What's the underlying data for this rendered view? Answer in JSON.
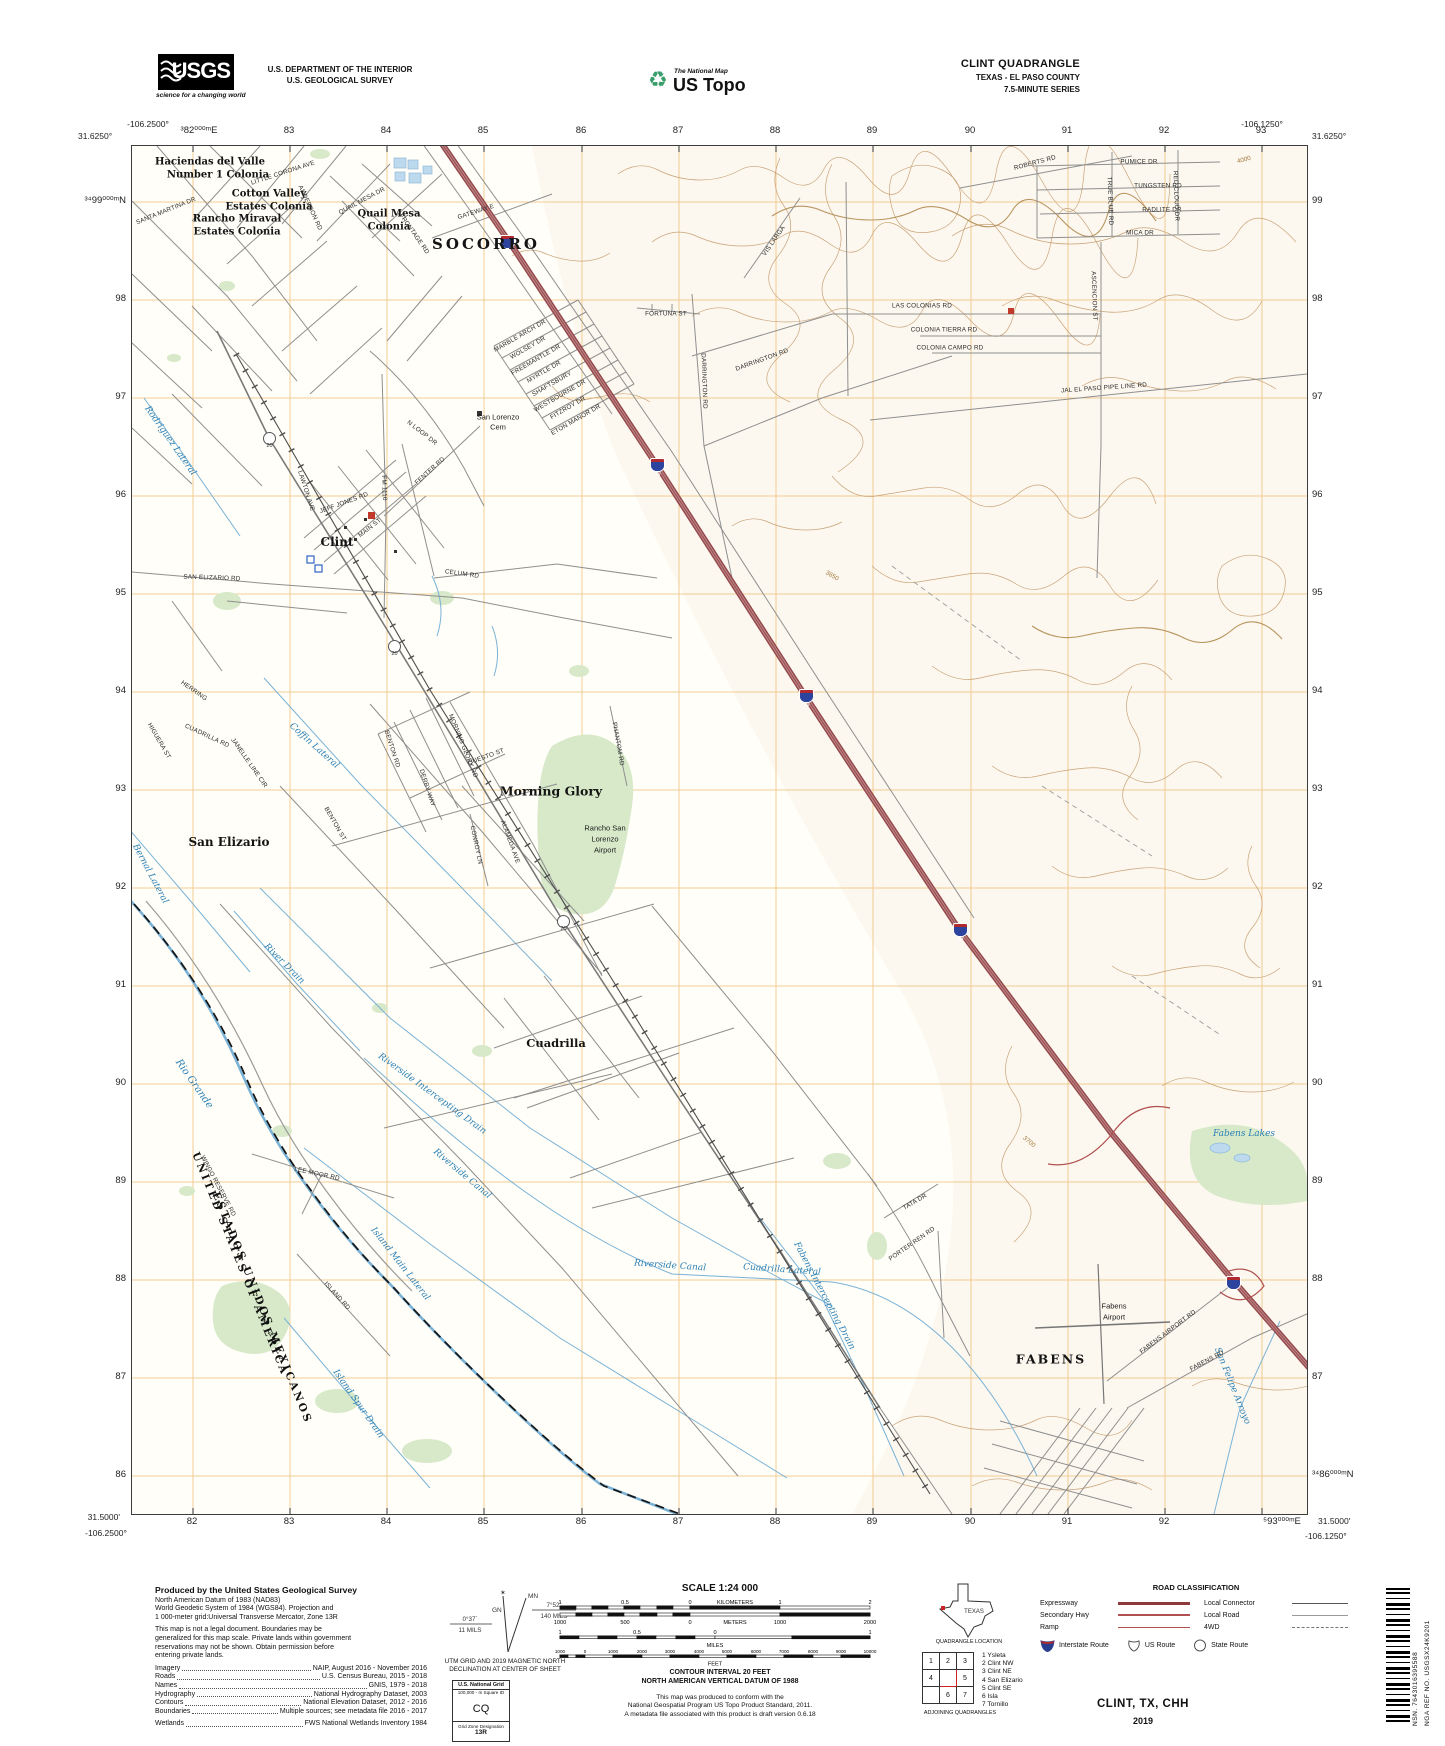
{
  "header": {
    "usgs": "USGS",
    "usgs_tagline": "science for a changing world",
    "dept_line1": "U.S. DEPARTMENT OF THE INTERIOR",
    "dept_line2": "U.S. GEOLOGICAL SURVEY",
    "ustopo_small": "The National Map",
    "ustopo_big": "US Topo",
    "quad_title": "CLINT QUADRANGLE",
    "quad_sub1": "TEXAS - EL PASO COUNTY",
    "quad_sub2": "7.5-MINUTE SERIES"
  },
  "edges": {
    "tl_lon": "-106.2500°",
    "tl_lat": "31.6250°",
    "tr_lon": "-106.1250°",
    "tr_lat": "31.6250°",
    "bl_lat": "31.5000'",
    "bl_lon": "-106.2500°",
    "br_lat": "31.5000'",
    "br_lon": "-106.1250°",
    "top": [
      "³82⁰⁰⁰ᵐE",
      "83",
      "84",
      "85",
      "86",
      "87",
      "88",
      "89",
      "90",
      "91",
      "92",
      "93"
    ],
    "bottom": [
      "82",
      "83",
      "84",
      "85",
      "86",
      "87",
      "88",
      "89",
      "90",
      "91",
      "92",
      "⁵93⁰⁰⁰ᵐE"
    ],
    "left": [
      "³⁴99⁰⁰⁰ᵐN",
      "98",
      "97",
      "96",
      "95",
      "94",
      "93",
      "92",
      "91",
      "90",
      "89",
      "88",
      "87",
      "86"
    ],
    "right": [
      "99",
      "98",
      "97",
      "96",
      "95",
      "94",
      "93",
      "92",
      "91",
      "90",
      "89",
      "88",
      "87",
      "³⁴86⁰⁰⁰ᵐN"
    ]
  },
  "map": {
    "i10": "10",
    "r20": "20",
    "towns": {
      "socorro": "SOCORRO",
      "clint": "Clint",
      "san_elizario": "San Elizario",
      "morning_glory": "Morning Glory",
      "cuadrilla": "Cuadrilla",
      "fabens": "FABENS"
    },
    "colonias": {
      "hdv1": "Haciendas del Valle",
      "hdv2": "Number 1 Colonia",
      "cv1": "Cotton Valley",
      "cv2": "Estates Colonia",
      "rm1": "Rancho Miraval",
      "rm2": "Estates Colonia",
      "qm1": "Quail Mesa",
      "qm2": "Colonia"
    },
    "sites": {
      "rsl1": "Rancho San",
      "rsl2": "Lorenzo",
      "rsl3": "Airport",
      "fa1": "Fabens",
      "fa2": "Airport",
      "cem1": "San Lorenzo",
      "cem2": "Cem"
    },
    "boundary": {
      "us": "UNITED STATES OF AMERICA",
      "mx": "ESTADOS UNIDOS MEXICANOS"
    },
    "water": [
      "Rio Grande",
      "Riverside Intercepting Drain",
      "Riverside Canal",
      "Island Main Lateral",
      "Island Spur Drain",
      "Bernal Lateral",
      "Coffin Lateral",
      "Rodriguez Lateral",
      "Riverside Canal",
      "Cuadrilla Lateral",
      "Fabens Intercepting Drain",
      "Fabens Lakes",
      "River Drain",
      "San Felipe Arroyo"
    ],
    "roads": [
      "SAN ELIZARIO RD",
      "JEFF JONES RD",
      "MAIN ST",
      "LAWTON AVE",
      "FM 1110",
      "N LOOP DR",
      "FENTER RD",
      "CELUM RD",
      "FRONTAGE RD",
      "GATEWAY E",
      "MARBLE ARCH DR",
      "WOLSEY DR",
      "FREEMANTLE DR",
      "MYRTLE DR",
      "SHAFTSBURY",
      "WESTBOURNE DR",
      "FITZROY DR",
      "ETON MANOR DR",
      "FORTUNA ST",
      "DARRINGTON RD",
      "DARRINGTON RD",
      "VIS LARGA",
      "JAL EL PASO PIPE LINE RD",
      "ROBERTS RD",
      "PUMICE DR",
      "TUNGSTEN RD",
      "RADLITE DR",
      "MICA DR",
      "TRUE BLUE RD",
      "RED CLOUD DR",
      "ASCENCION ST",
      "LAS COLONIAS RD",
      "COLONIA TIERRA RD",
      "COLONIA CAMPO RD",
      "CUADRILLA RD",
      "HERRING",
      "JANELLE LINE CIR",
      "BENTON RD",
      "BENTON ST",
      "DERBY WAY",
      "MORNING GLORY RD",
      "QUESTO ST",
      "CONROY LN",
      "ALAMEDA AVE",
      "PHANTOM RD",
      "HIGUERA ST",
      "LEE MOOR RD",
      "ISLAND RD",
      "WINGO RESERVE RD",
      "TATA DR",
      "PORTER REN RD",
      "FABENS AIRPORT RD",
      "FABENS RD",
      "SANTA MARTINA DR",
      "ANDERSON RD",
      "QUAIL MESA DR",
      "LITTLE CORONA AVE"
    ],
    "contour_labels": [
      "3700",
      "3650",
      "4000"
    ]
  },
  "footer": {
    "produced_by": "Produced by the United States Geological Survey",
    "datum_lines": [
      "North American Datum of 1983 (NAD83)",
      "World Geodetic System of 1984 (WGS84).  Projection and",
      "1 000-meter grid:Universal Transverse Mercator, Zone 13R"
    ],
    "legal_lines": [
      "This map is not a legal document. Boundaries may be",
      "generalized for this map scale. Private lands within government",
      "reservations may not be shown. Obtain permission before",
      "entering private lands."
    ],
    "credits": [
      {
        "label": "Imagery",
        "value": "NAIP, August 2016 - November 2016"
      },
      {
        "label": "Roads",
        "value": "U.S. Census Bureau, 2015 - 2018"
      },
      {
        "label": "Names",
        "value": "GNIS, 1979 - 2018"
      },
      {
        "label": "Hydrography",
        "value": "National Hydrography Dataset, 2003"
      },
      {
        "label": "Contours",
        "value": "National Elevation Dataset, 2012 - 2016"
      },
      {
        "label": "Boundaries",
        "value": "Multiple sources; see metadata file 2016 - 2017"
      },
      {
        "label": "Wetlands",
        "value": "FWS National Wetlands Inventory 1984"
      }
    ],
    "declination": {
      "mn": "MN",
      "gn": "GN",
      "left_deg": "0°37´",
      "left_mils": "11 MILS",
      "right_deg": "7°52´",
      "right_mils": "140 MILS",
      "note1": "UTM GRID AND 2019 MAGNETIC NORTH",
      "note2": "DECLINATION AT CENTER OF SHEET"
    },
    "usng": {
      "title": "U.S. National Grid",
      "sub": "100,000 - m Square ID",
      "square": "CQ",
      "zone_label": "Grid Zone Designation",
      "zone": "13R"
    },
    "scale": {
      "title": "SCALE 1:24 000",
      "km_label": "KILOMETERS",
      "m_label": "METERS",
      "mi_label": "MILES",
      "ft_label": "FEET",
      "km": [
        "1",
        "0.5",
        "0",
        "1",
        "2"
      ],
      "m": [
        "1000",
        "500",
        "0",
        "1000",
        "2000"
      ],
      "mi": [
        "1",
        "0.5",
        "0",
        "1"
      ],
      "ft": [
        "1000",
        "0",
        "1000",
        "2000",
        "3000",
        "4000",
        "5000",
        "6000",
        "7000",
        "8000",
        "9000",
        "10000"
      ]
    },
    "contour_note1": "CONTOUR INTERVAL 20 FEET",
    "contour_note2": "NORTH AMERICAN VERTICAL DATUM OF 1988",
    "conform_lines": [
      "This map was produced to conform with the",
      "National Geospatial Program US Topo Product Standard, 2011.",
      "A metadata file associated with this product is draft version 0.6.18"
    ],
    "quad_location": {
      "state": "TEXAS",
      "caption": "QUADRANGLE LOCATION"
    },
    "adjoining": {
      "caption": "ADJOINING QUADRANGLES",
      "cells": [
        "1",
        "2",
        "3",
        "4",
        "5",
        "6",
        "7"
      ],
      "names": [
        "1 Ysleta",
        "2 Clint NW",
        "3 Clint NE",
        "4 San Elizario",
        "5 Clint SE",
        "6 Isla",
        "7 Tornillo"
      ]
    },
    "road_class": {
      "title": "ROAD CLASSIFICATION",
      "expressway": "Expressway",
      "secondary": "Secondary Hwy",
      "ramp": "Ramp",
      "local_connector": "Local Connector",
      "local_road": "Local Road",
      "fourwd": "4WD",
      "interstate": "Interstate Route",
      "us_route": "US Route",
      "state_route": "State Route"
    },
    "sheet_title": "CLINT, TX, CHH",
    "sheet_year": "2019",
    "barcode_nsn": "NSN. 7643016395588",
    "barcode_ref": "NGA REF NO. USGSX24K9201"
  }
}
